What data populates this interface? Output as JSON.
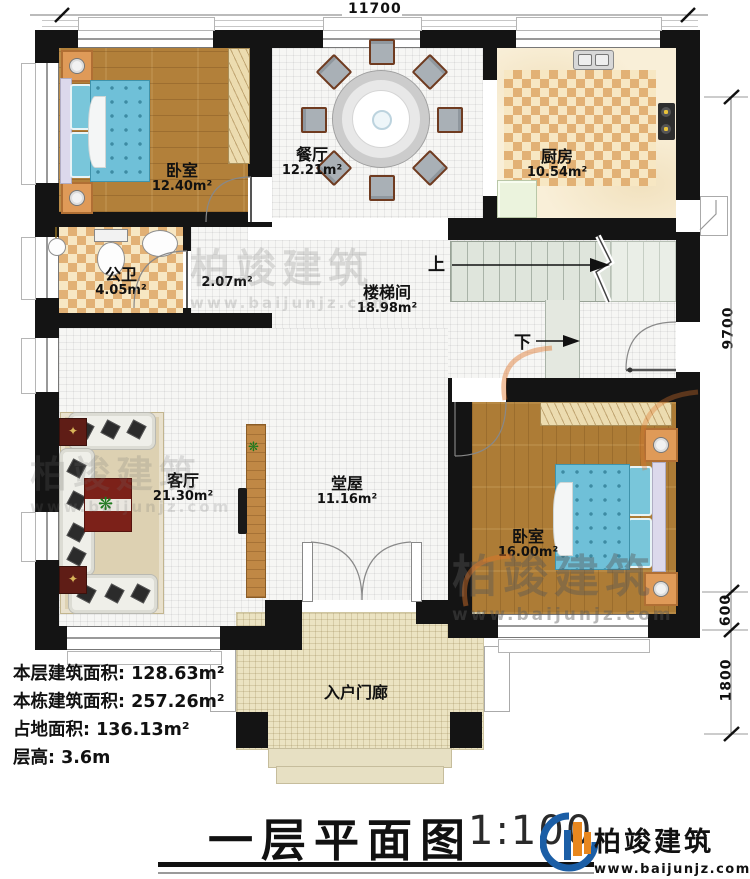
{
  "title": {
    "main": "一层平面图",
    "scale": "1:100"
  },
  "brand": {
    "name": "柏竣建筑",
    "url": "www.baijunjz.com"
  },
  "stats": {
    "line1_label": "本层建筑面积:",
    "line1_value": "128.63m²",
    "line2_label": "本栋建筑面积:",
    "line2_value": "257.26m²",
    "line3_label": "占地面积:",
    "line3_value": "136.13m²",
    "line4_label": "层高:",
    "line4_value": "3.6m"
  },
  "rooms": {
    "bedroom1": {
      "name": "卧室",
      "area": "12.40m²"
    },
    "dining": {
      "name": "餐厅",
      "area": "12.21m²"
    },
    "kitchen": {
      "name": "厨房",
      "area": "10.54m²"
    },
    "bathroom": {
      "name": "公卫",
      "area": "4.05m²"
    },
    "closet": {
      "area": "2.07m²"
    },
    "stairwell": {
      "name": "楼梯间",
      "area": "18.98m²"
    },
    "living": {
      "name": "客厅",
      "area": "21.30m²"
    },
    "hall": {
      "name": "堂屋",
      "area": "11.16m²"
    },
    "bedroom2": {
      "name": "卧室",
      "area": "16.00m²"
    },
    "porch": {
      "name": "入户门廊"
    }
  },
  "stairs": {
    "up": "上",
    "down": "下"
  },
  "dimensions": {
    "top": "11700",
    "right_total": "9700",
    "right_step": "600",
    "right_porch": "1800"
  },
  "watermark": {
    "name": "柏竣建筑",
    "url": "www.baijunjz.com"
  }
}
